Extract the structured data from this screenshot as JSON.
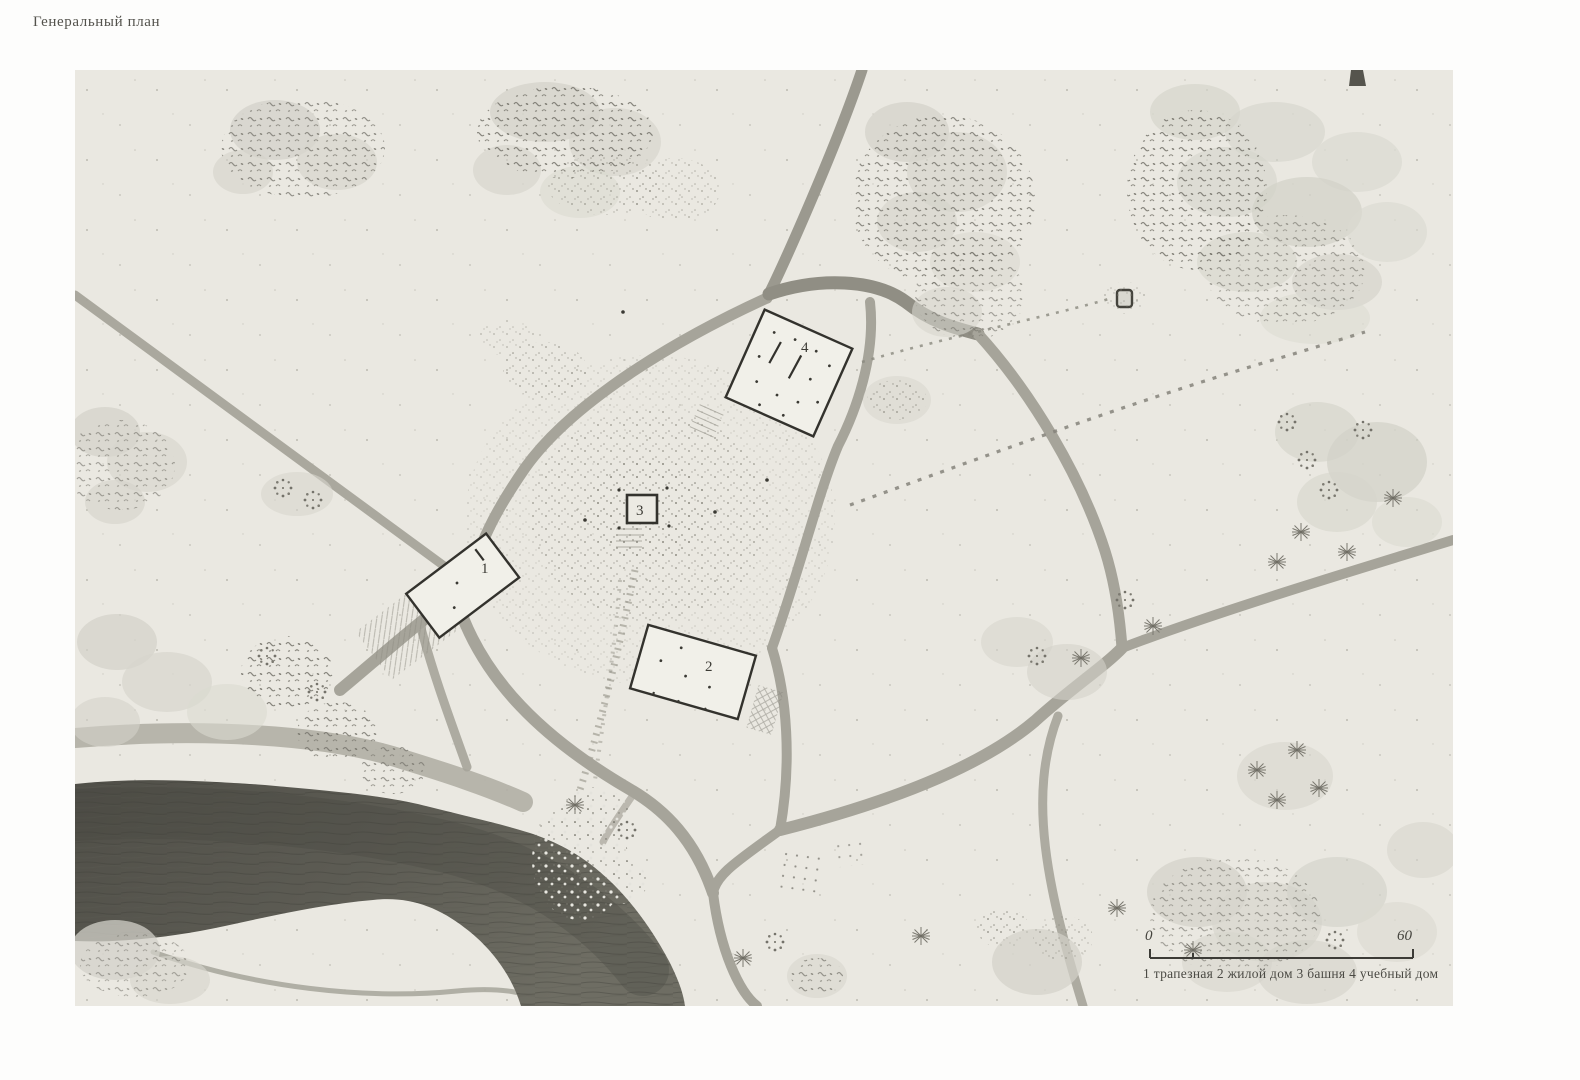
{
  "title": "Генеральный план",
  "legend": {
    "text": "1 трапезная 2 жилой дом 3 башня 4 учебный дом"
  },
  "scale_bar": {
    "start_label": "0",
    "end_label": "60"
  },
  "buildings": [
    {
      "number": "1",
      "name": "трапезная"
    },
    {
      "number": "2",
      "name": "жилой дом"
    },
    {
      "number": "3",
      "name": "башня"
    },
    {
      "number": "4",
      "name": "учебный дом"
    }
  ],
  "colors": {
    "paper": "#fdfdfc",
    "drawing_background": "#EAE8E1",
    "road": "#a6a49a",
    "river": "#53524b",
    "tree_wash": "#d3d2c9",
    "ink": "#33322d"
  }
}
